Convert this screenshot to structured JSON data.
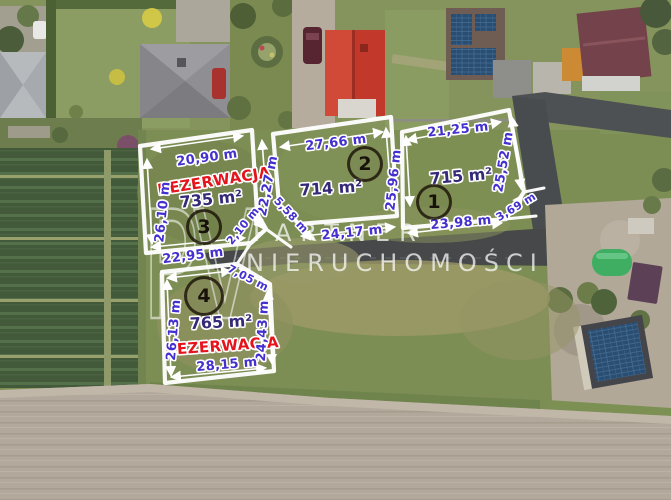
{
  "watermark": {
    "logo": "PV",
    "line1": "PARTNER",
    "line2": "NIERUCHOMOŚCI"
  },
  "colors": {
    "measurement_text": "#4330cf",
    "area_text": "#352a78",
    "reservation_text": "#e5131c",
    "boundary_line": "#ffffff",
    "road": "#47494b",
    "grass": "#7d8e55",
    "crop_field": "#42593a",
    "plowed_field": "#b2a89b"
  },
  "plots": [
    {
      "number": "1",
      "area_label": "715 m²",
      "sides": {
        "top": "21,25 m",
        "right": "25,52 m",
        "bottom": "23,98 m",
        "corner": "3,69 m"
      }
    },
    {
      "number": "2",
      "area_label": "714 m²",
      "sides": {
        "top": "27,66 m",
        "right": "25,96 m",
        "bottom": "24,17 m",
        "corner": "5,58 m"
      }
    },
    {
      "number": "3",
      "area_label": "735 m²",
      "reservation_label": "REZERWACJA",
      "sides": {
        "top": "20,90 m",
        "left": "26,10 m",
        "right": "22,27 m",
        "bottom": "22,95 m",
        "corner": "2,10 m"
      }
    },
    {
      "number": "4",
      "area_label": "765 m²",
      "reservation_label": "REZERWACJA",
      "sides": {
        "left": "26,13 m",
        "right": "24,43 m",
        "bottom": "28,15 m",
        "corner": "7,05 m"
      }
    }
  ]
}
